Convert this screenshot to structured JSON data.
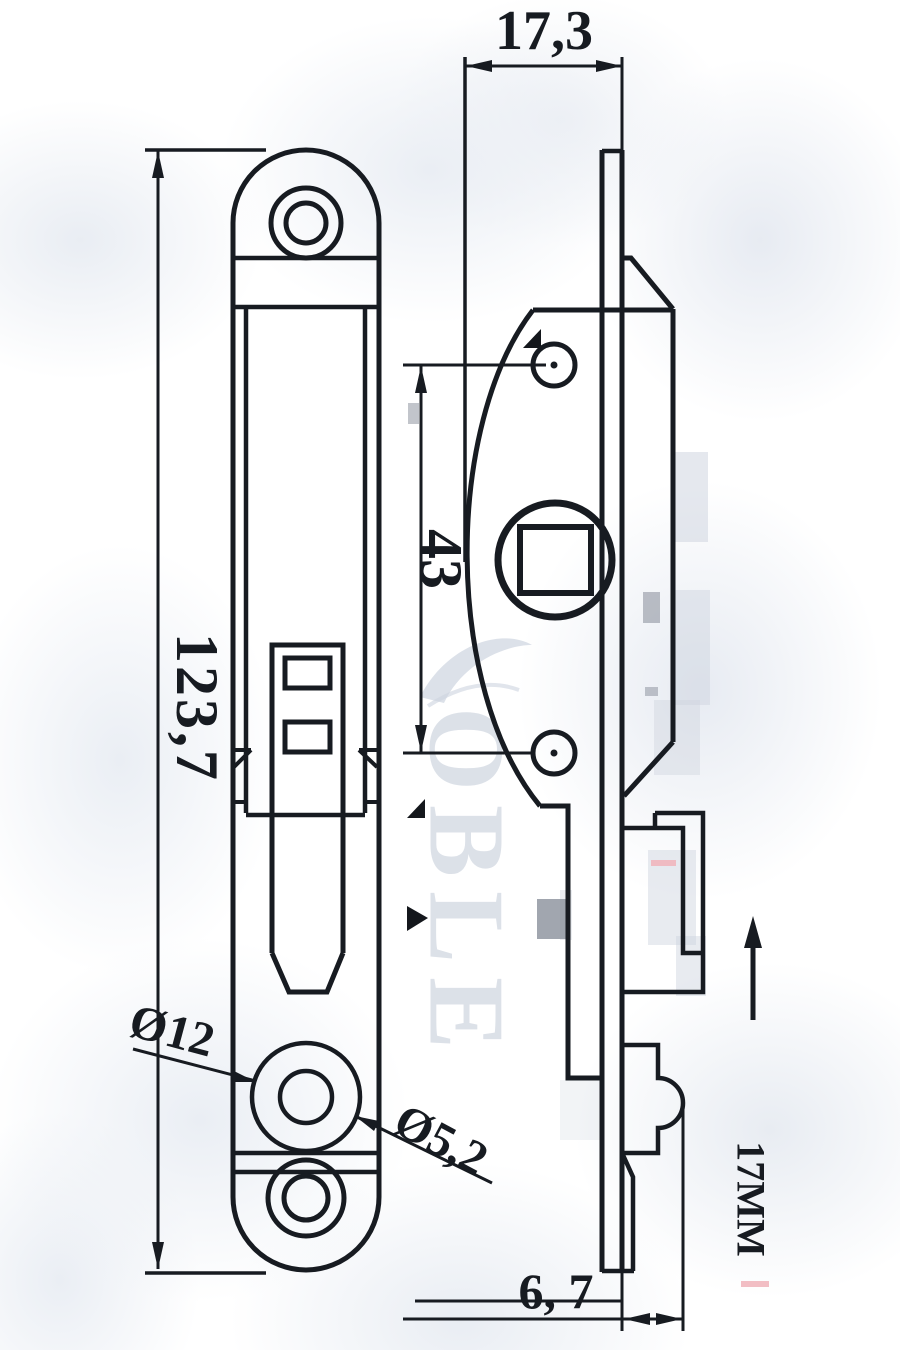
{
  "watermark": {
    "text": "OBLE"
  },
  "dimensions": {
    "top_width": "17,3",
    "overall_height": "123,7",
    "screw_hole_spacing": "43",
    "counterbore_diameter": "Ø12",
    "hole_diameter": "Ø5,2",
    "faceplate_offset": "6, 7",
    "bolt_throw": "17MM"
  },
  "colors": {
    "ink": "#171b21",
    "watermark_gray": "#d7dce5",
    "artifact_gray": "#8f95a0",
    "artifact_pink": "#f0b3ba",
    "background": "#ffffff"
  }
}
